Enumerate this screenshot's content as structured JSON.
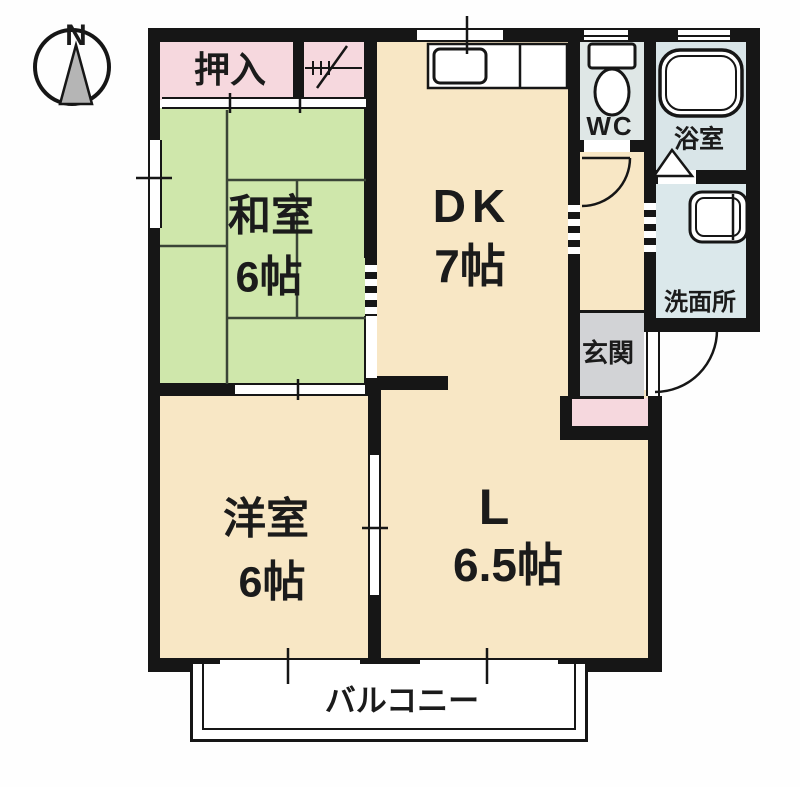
{
  "compass": {
    "north_label": "N"
  },
  "rooms": {
    "closet": {
      "label": "押入"
    },
    "japanese_room": {
      "name": "和室",
      "size": "6帖"
    },
    "dining_kitchen": {
      "name": "DK",
      "size": "7帖"
    },
    "toilet": {
      "label": "WC"
    },
    "bathroom": {
      "label": "浴室"
    },
    "washroom": {
      "label": "洗面所"
    },
    "entrance": {
      "label": "玄関"
    },
    "western_room": {
      "name": "洋室",
      "size": "6帖"
    },
    "living": {
      "name": "L",
      "size": "6.5帖"
    },
    "balcony": {
      "label": "バルコニー"
    }
  },
  "colors": {
    "wall": "#161616",
    "tatami_green": "#cfe7ab",
    "room_cream": "#f8e7c5",
    "closet_pink": "#f6d8de",
    "wet_area_blue": "#dce7e9",
    "entrance_gray": "#d2d3d6"
  }
}
